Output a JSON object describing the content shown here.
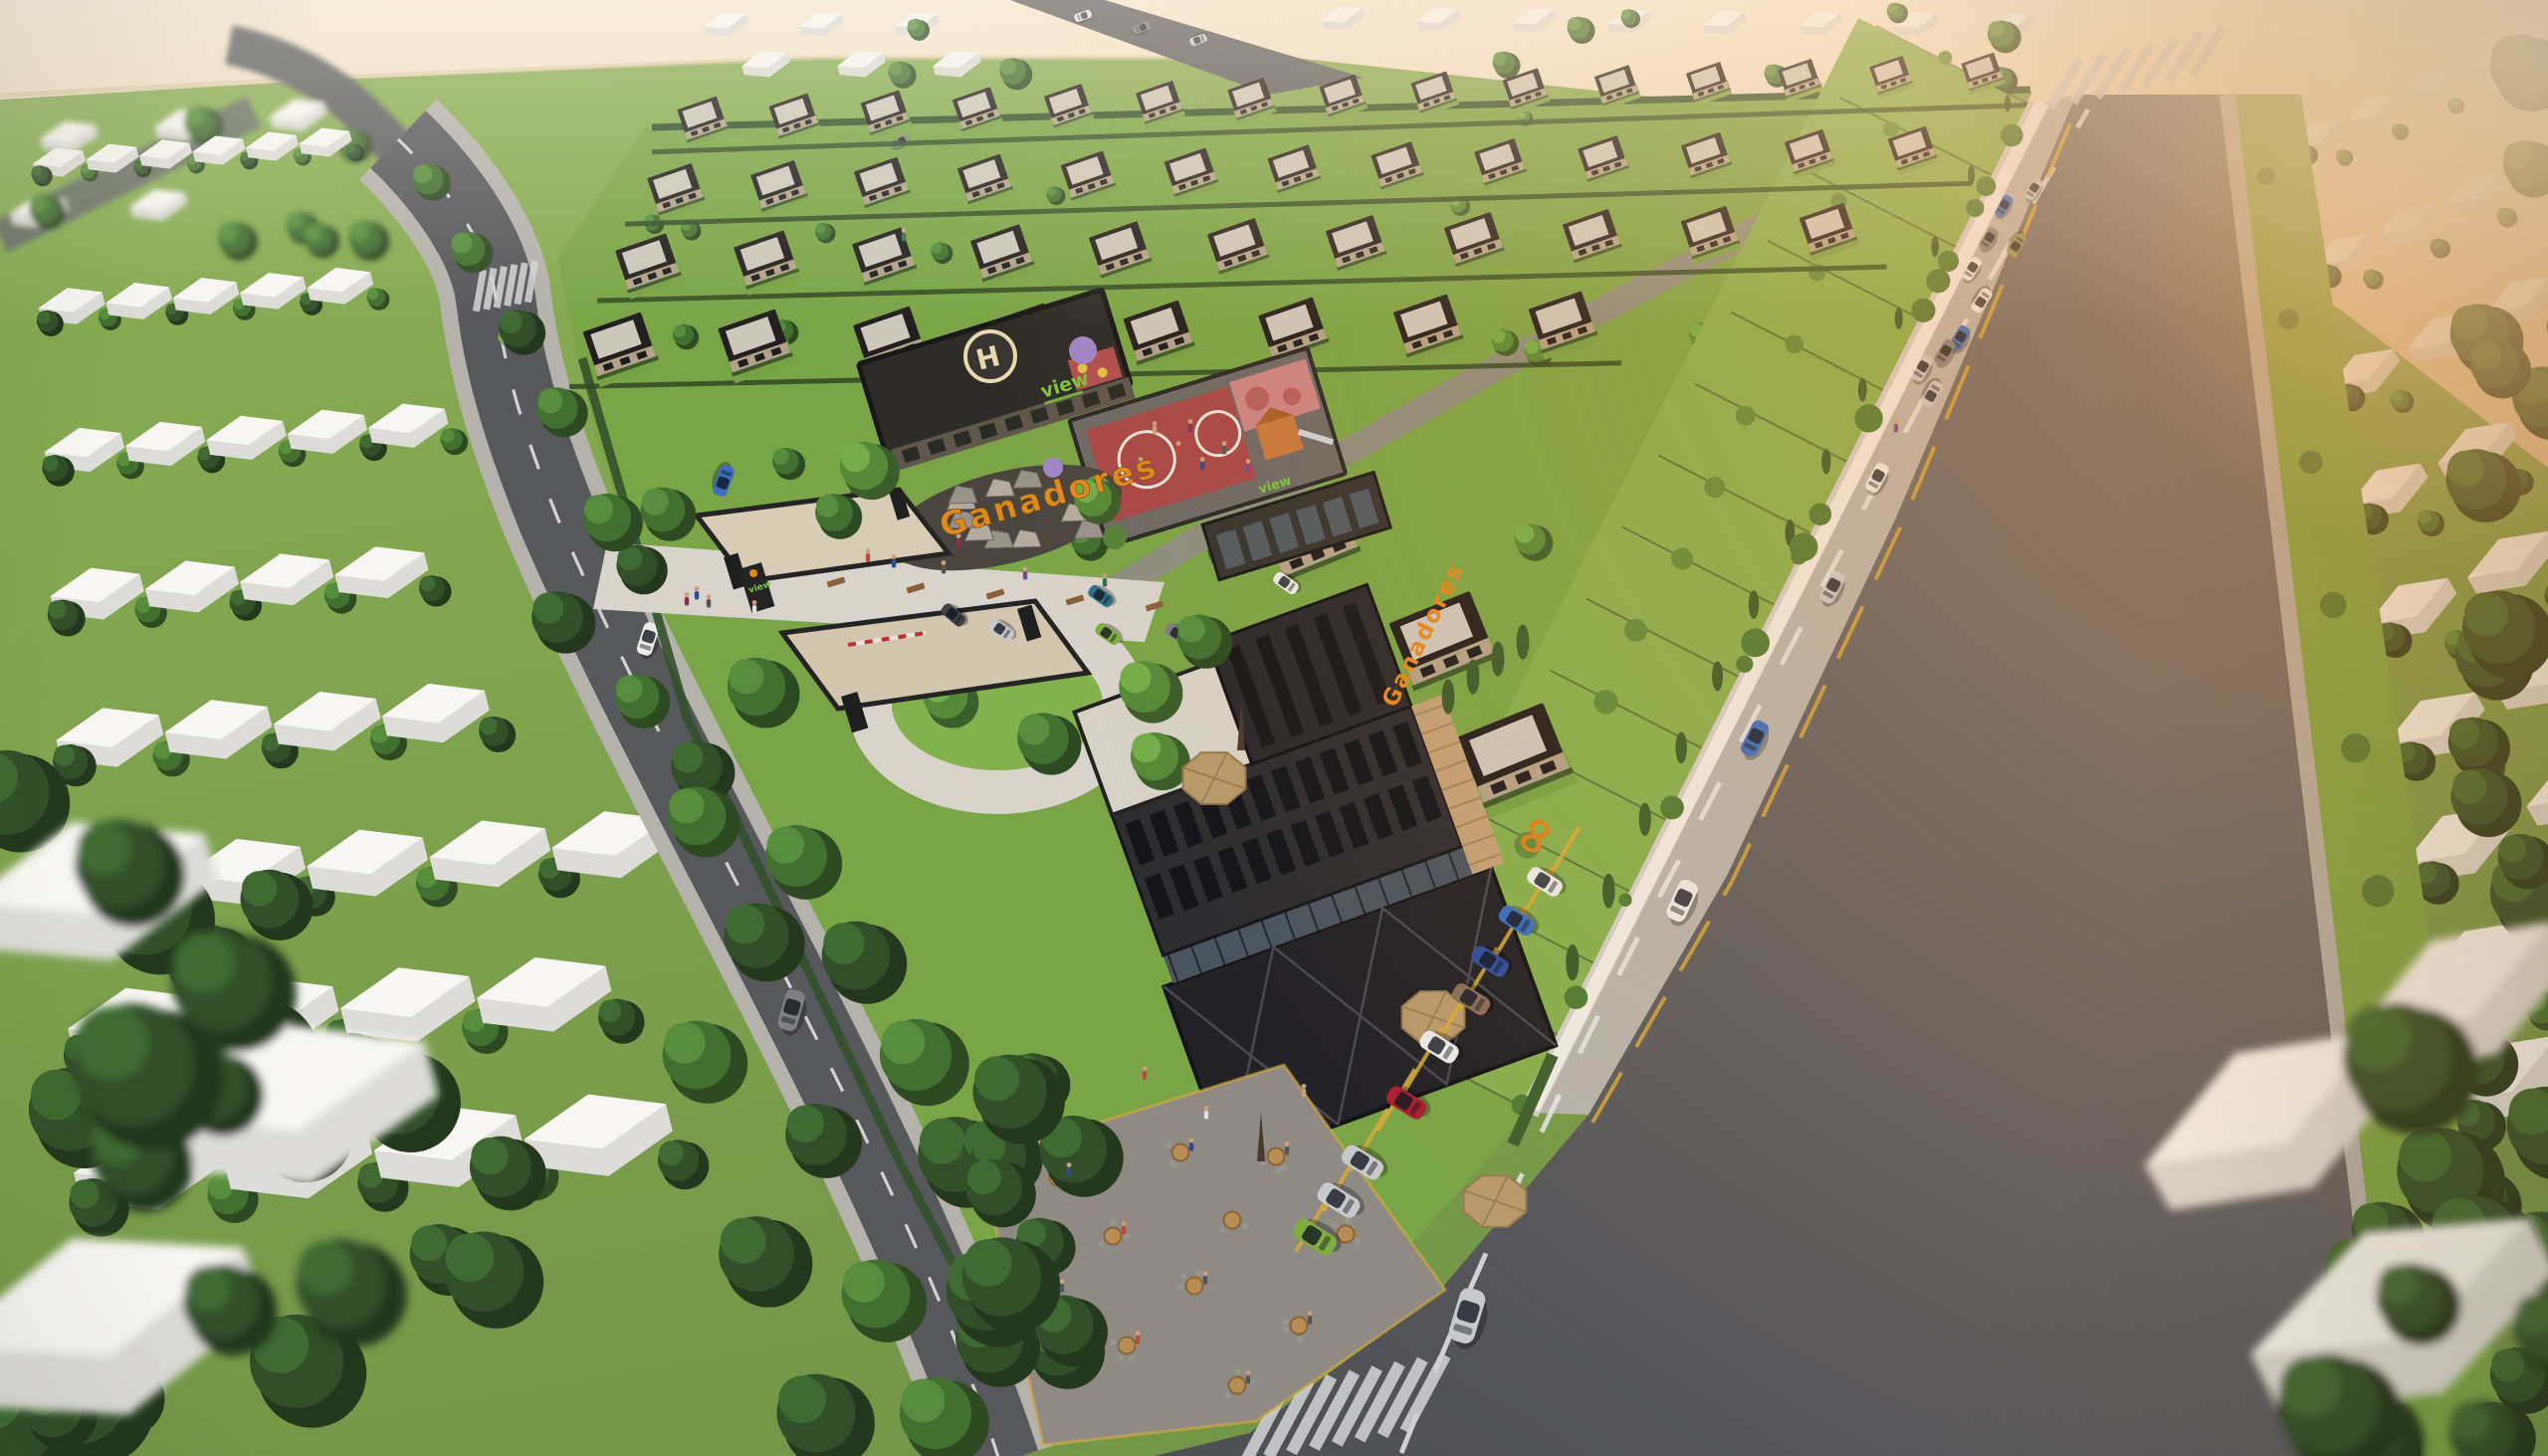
{
  "scene": {
    "description": "Aerial 3D architectural rendering of the Ganadores gated villa community at golden hour, beside a beach, with clubhouse helipad, rooftop playground, commercial block, cafe terrace and tree-lined roads",
    "signs": {
      "brand_building": "Ganadores",
      "brand_rocks": "Ganadores",
      "clubhouse_sign": "view",
      "retail_sign": "view",
      "gate_sign": "view",
      "helipad_letter": "H",
      "wall_logo_glyph": "∞"
    },
    "palette": {
      "grass_base": "#7da448",
      "grass_parcel": "#7aa547",
      "grass_circle": "#83b14e",
      "asphalt": "#55565a",
      "asphalt_light": "#66676c",
      "sidewalk": "#b7b4ae",
      "paving": "#d8d3cb",
      "sand_top": "#f2e6cf",
      "sand_bottom": "#e0c49e",
      "roof_dark": "#221f1e",
      "roof_deck": "#cdc7bc",
      "facade": "#b2a289",
      "building_dark": "#2a292c",
      "building_mid": "#2e2d30",
      "wood": "#c2a176",
      "wall_white": "#efece7",
      "accent_orange": "#e08a1e",
      "sign_green": "#7dc63e",
      "court_red": "#a84848",
      "court_pink": "#cc8484",
      "helipad_ring": "#e8d9b0",
      "stall_yellow": "#d8ab39",
      "dash_white": "#e8e8e6",
      "tree_dark": [
        "#24381d",
        "#31502a",
        "#3f6a31"
      ],
      "tree_mid": [
        "#2d4a22",
        "#417030",
        "#578e3d"
      ],
      "tree_light": [
        "#3b5e2a",
        "#578a38",
        "#74ae4b"
      ],
      "car": {
        "white": "#ebebe9",
        "silver": "#c7c9cc",
        "gray": "#7e8084",
        "dark": "#3f4246",
        "blue": "#3b6ec0",
        "blue2": "#2f4d9e",
        "red": "#a8212e",
        "green": "#7fae3e",
        "teal": "#2e6f86",
        "brown": "#8a6e5c",
        "olive": "#8f8f5a"
      }
    },
    "cars": {
      "road_right": [
        [
          2043,
          190,
          33,
          0.5,
          "silver"
        ],
        [
          2013,
          207,
          33,
          0.5,
          "blue"
        ],
        [
          1998,
          240,
          33,
          0.52,
          "gray"
        ],
        [
          2026,
          246,
          213,
          0.52,
          "olive"
        ],
        [
          1981,
          270,
          33,
          0.54,
          "white"
        ],
        [
          1991,
          302,
          213,
          0.56,
          "white"
        ],
        [
          1969,
          340,
          31,
          0.58,
          "blue"
        ],
        [
          1954,
          354,
          31,
          0.58,
          "gray"
        ],
        [
          1931,
          370,
          31,
          0.6,
          "silver"
        ],
        [
          1941,
          396,
          211,
          0.6,
          "silver"
        ],
        [
          1886,
          480,
          29,
          0.66,
          "white"
        ],
        [
          1841,
          590,
          29,
          0.72,
          "silver"
        ],
        [
          1763,
          742,
          27,
          0.8,
          "blue"
        ],
        [
          1690,
          905,
          25,
          0.92,
          "white"
        ],
        [
          1474,
          1322,
          17,
          1.2,
          "silver"
        ]
      ],
      "road_left": [
        [
          509,
          331,
          14,
          0.6,
          "green"
        ],
        [
          727,
          483,
          200,
          0.68,
          "blue"
        ],
        [
          651,
          642,
          18,
          0.72,
          "white"
        ],
        [
          795,
          1015,
          16,
          0.9,
          "gray"
        ]
      ],
      "inner_parked": [
        [
          1106,
          599,
          -55,
          0.58,
          "teal"
        ],
        [
          1006,
          633,
          -55,
          0.58,
          "silver"
        ],
        [
          1113,
          637,
          -55,
          0.58,
          "green"
        ],
        [
          1183,
          637,
          -55,
          0.58,
          "gray"
        ],
        [
          1292,
          586,
          -55,
          0.58,
          "white"
        ],
        [
          958,
          618,
          -50,
          0.58,
          "dark"
        ]
      ],
      "angled_parking": [
        [
          1552,
          886,
          -58,
          0.8,
          "white"
        ],
        [
          1524,
          925,
          -58,
          0.82,
          "blue"
        ],
        [
          1497,
          966,
          -58,
          0.84,
          "blue2"
        ],
        [
          1478,
          1004,
          -58,
          0.86,
          "brown"
        ],
        [
          1446,
          1052,
          -58,
          0.88,
          "white"
        ],
        [
          1413,
          1108,
          -58,
          0.9,
          "red"
        ],
        [
          1369,
          1168,
          -58,
          0.94,
          "silver"
        ],
        [
          1345,
          1206,
          -58,
          0.96,
          "silver"
        ],
        [
          1321,
          1243,
          -58,
          0.98,
          "green"
        ]
      ],
      "top_band": [
        [
          1088,
          16,
          70,
          0.38,
          "white"
        ],
        [
          1147,
          28,
          70,
          0.38,
          "gray"
        ],
        [
          1204,
          40,
          250,
          0.38,
          "silver"
        ],
        [
          905,
          142,
          63,
          0.4,
          "gray"
        ]
      ]
    },
    "cafe": {
      "tables": [
        [
          1063,
          1183
        ],
        [
          1118,
          1242
        ],
        [
          1056,
          1300
        ],
        [
          1132,
          1352
        ],
        [
          1200,
          1292
        ],
        [
          1238,
          1226
        ],
        [
          1186,
          1158
        ],
        [
          1282,
          1162
        ],
        [
          1305,
          1332
        ],
        [
          1243,
          1392
        ],
        [
          1352,
          1240
        ]
      ],
      "umbrellas_open": [
        [
          1502,
          1207
        ],
        [
          1220,
          782
        ],
        [
          1440,
          1022
        ]
      ],
      "umbrellas_closed": [
        [
          1267,
          1143
        ],
        [
          1247,
          730
        ]
      ]
    },
    "people": [
      [
        872,
        560
      ],
      [
        898,
        566
      ],
      [
        948,
        572
      ],
      [
        1030,
        578
      ],
      [
        1110,
        585
      ],
      [
        690,
        604
      ],
      [
        758,
        612
      ],
      [
        1160,
        432
      ],
      [
        1184,
        452
      ],
      [
        1208,
        468
      ],
      [
        1230,
        452
      ],
      [
        1254,
        470
      ],
      [
        1146,
        468
      ],
      [
        1196,
        430
      ],
      [
        1212,
        1120
      ],
      [
        1310,
        1098
      ],
      [
        1150,
        1080
      ],
      [
        700,
        598
      ],
      [
        712,
        606
      ],
      [
        1905,
        430
      ],
      [
        908,
        238
      ],
      [
        963,
        545
      ]
    ],
    "layout": {
      "villa_rows": [
        [
          705,
          118,
          15,
          0.55
        ],
        [
          678,
          188,
          13,
          0.62
        ],
        [
          650,
          262,
          11,
          0.71
        ],
        [
          622,
          345,
          8,
          0.81
        ]
      ],
      "chain_villas": [
        [
          1185,
          445,
          0.95
        ],
        [
          1315,
          535,
          1.05
        ],
        [
          1448,
          640,
          1.15
        ],
        [
          1520,
          755,
          1.22
        ]
      ],
      "context_left": {
        "rows": 8,
        "o1": [
          60,
          165
        ],
        "o2": [
          150,
          1180
        ]
      },
      "context_right": {
        "rows": 9,
        "o1": [
          2330,
          140
        ],
        "o2": [
          2520,
          1090
        ]
      },
      "big_houses_bl": [
        [
          95,
          905,
          2.4,
          -16
        ],
        [
          295,
          1120,
          2.8,
          -14
        ],
        [
          105,
          1345,
          3.1,
          -18
        ]
      ],
      "big_houses_br": [
        [
          2290,
          1135,
          2.6,
          -30
        ],
        [
          2480,
          1010,
          2.2,
          -30
        ],
        [
          2420,
          1330,
          3.0,
          -26
        ]
      ]
    }
  }
}
